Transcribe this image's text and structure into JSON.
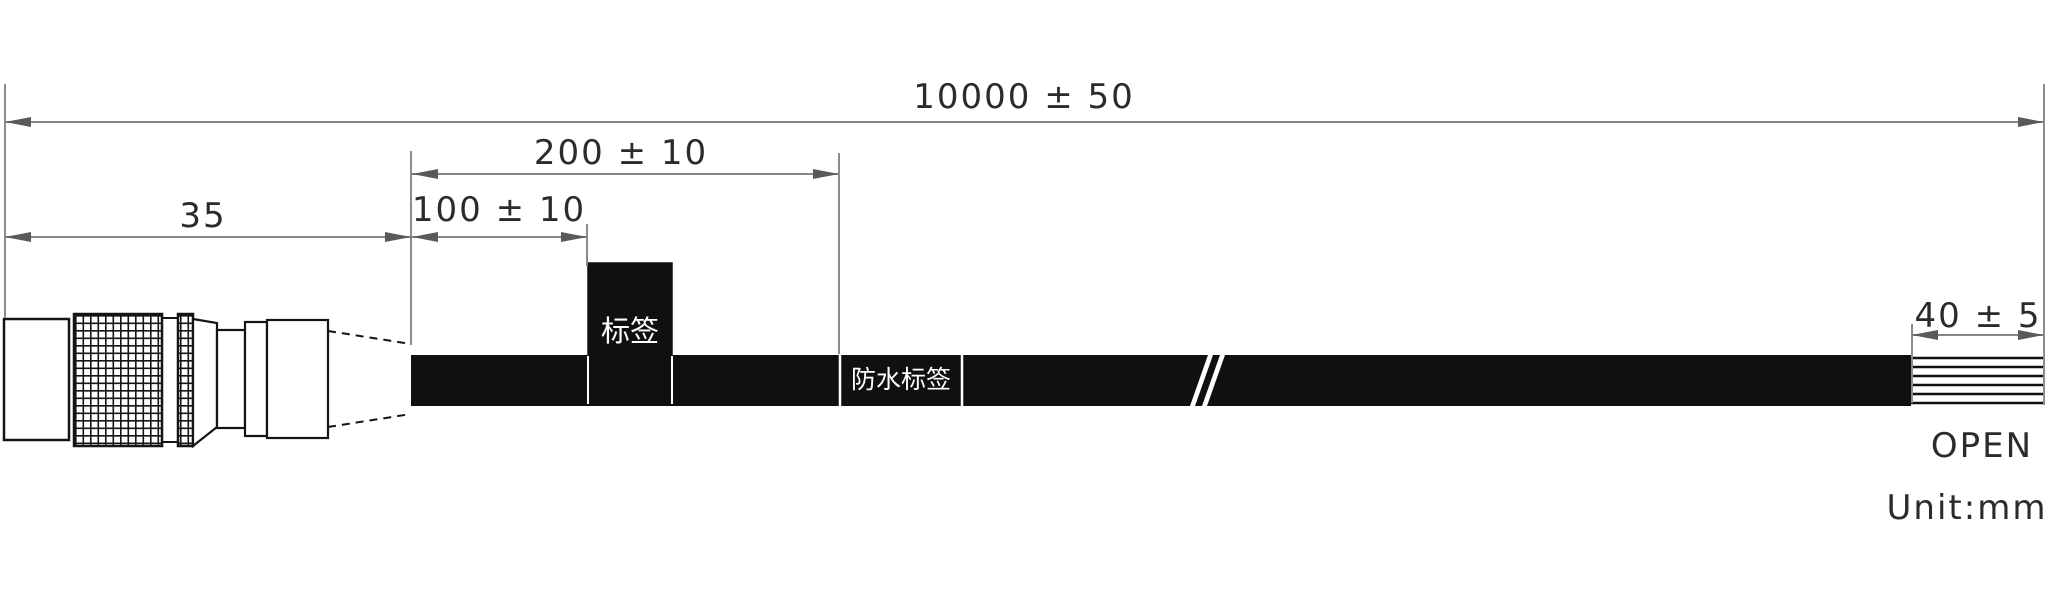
{
  "drawing": {
    "dimensions": {
      "overall_length": "10000 ± 50",
      "connector_length": "35",
      "waterproof_label_distance": "200 ± 10",
      "label_distance": "100 ± 10",
      "strip_length": "40 ± 5"
    },
    "labels": {
      "cable_label": "标签",
      "waterproof_label": "防水标签"
    },
    "end_label": "OPEN",
    "unit_note": "Unit:mm",
    "icons": {
      "cable_break": "cable-break-double-slash",
      "knurl": "crosshatch-knurl-texture"
    },
    "colors": {
      "part_line": "#141414",
      "dimension_line": "#868686",
      "arrowhead": "#5a5a5a",
      "text": "#2b2b2b",
      "background": "#ffffff",
      "cable_fill": "#101010",
      "label_text": "#ffffff"
    }
  }
}
